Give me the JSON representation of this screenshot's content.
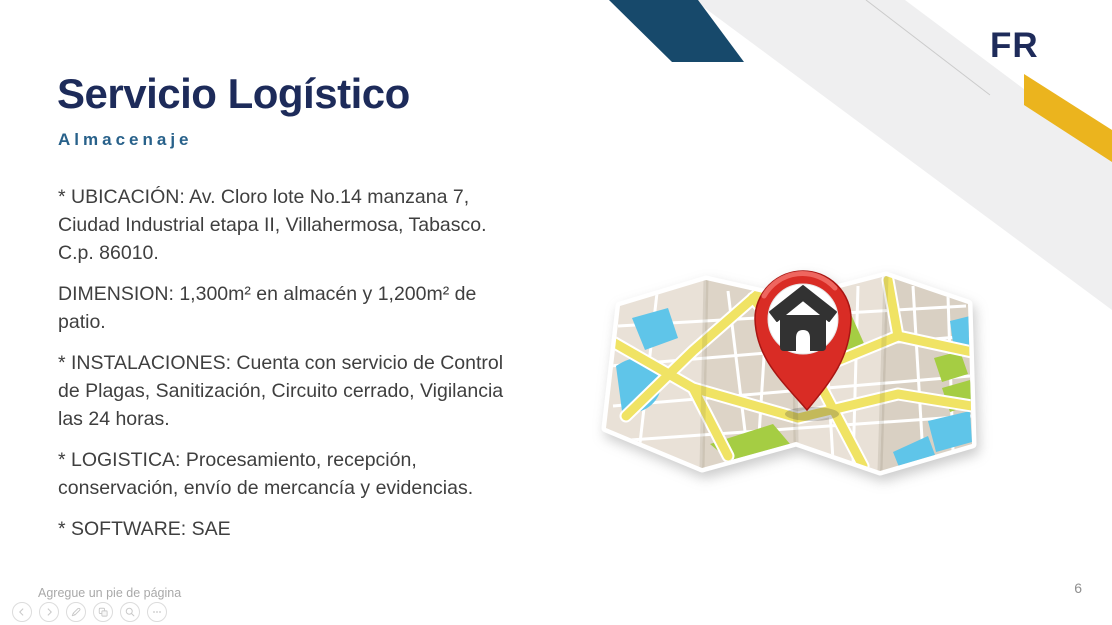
{
  "slide": {
    "logo_text": "FR",
    "title": "Servicio Logístico",
    "subtitle": "Almacenaje",
    "body": {
      "paragraphs": [
        "* UBICACIÓN: Av. Cloro lote No.14 manzana 7, Ciudad Industrial etapa II, Villahermosa, Tabasco. C.p. 86010.",
        "DIMENSION: 1,300m² en almacén y 1,200m² de patio.",
        "* INSTALACIONES: Cuenta con servicio de Control de Plagas, Sanitización, Circuito cerrado, Vigilancia las 24 horas.",
        "* LOGISTICA: Procesamiento, recepción, conservación, envío de mercancía y evidencias.",
        "* SOFTWARE: SAE"
      ]
    },
    "illustration": {
      "icon": "folded-map-with-red-location-pin-house-icon"
    },
    "footer": {
      "placeholder_text": "Agregue un pie de página",
      "slide_number": "6"
    },
    "view_toolbar": {
      "buttons": [
        {
          "icon": "previous-slide-arrow-icon"
        },
        {
          "icon": "next-slide-arrow-icon"
        },
        {
          "icon": "pen-annotate-icon"
        },
        {
          "icon": "see-all-slides-icon"
        },
        {
          "icon": "zoom-magnifier-icon"
        },
        {
          "icon": "more-options-ellipsis-icon"
        }
      ]
    },
    "colors": {
      "title_navy": "#1d2b5a",
      "subtitle_blue": "#28618a",
      "navy_band": "#17496b",
      "accent_yellow": "#ebb41e",
      "decor_gray": "#efeff0",
      "body_text_gray": "#3f3f3f",
      "pin_red": "#d92c25",
      "map_yellow_road": "#f0e364",
      "map_water_blue": "#5fc5e9",
      "map_green": "#a5cd43"
    }
  }
}
